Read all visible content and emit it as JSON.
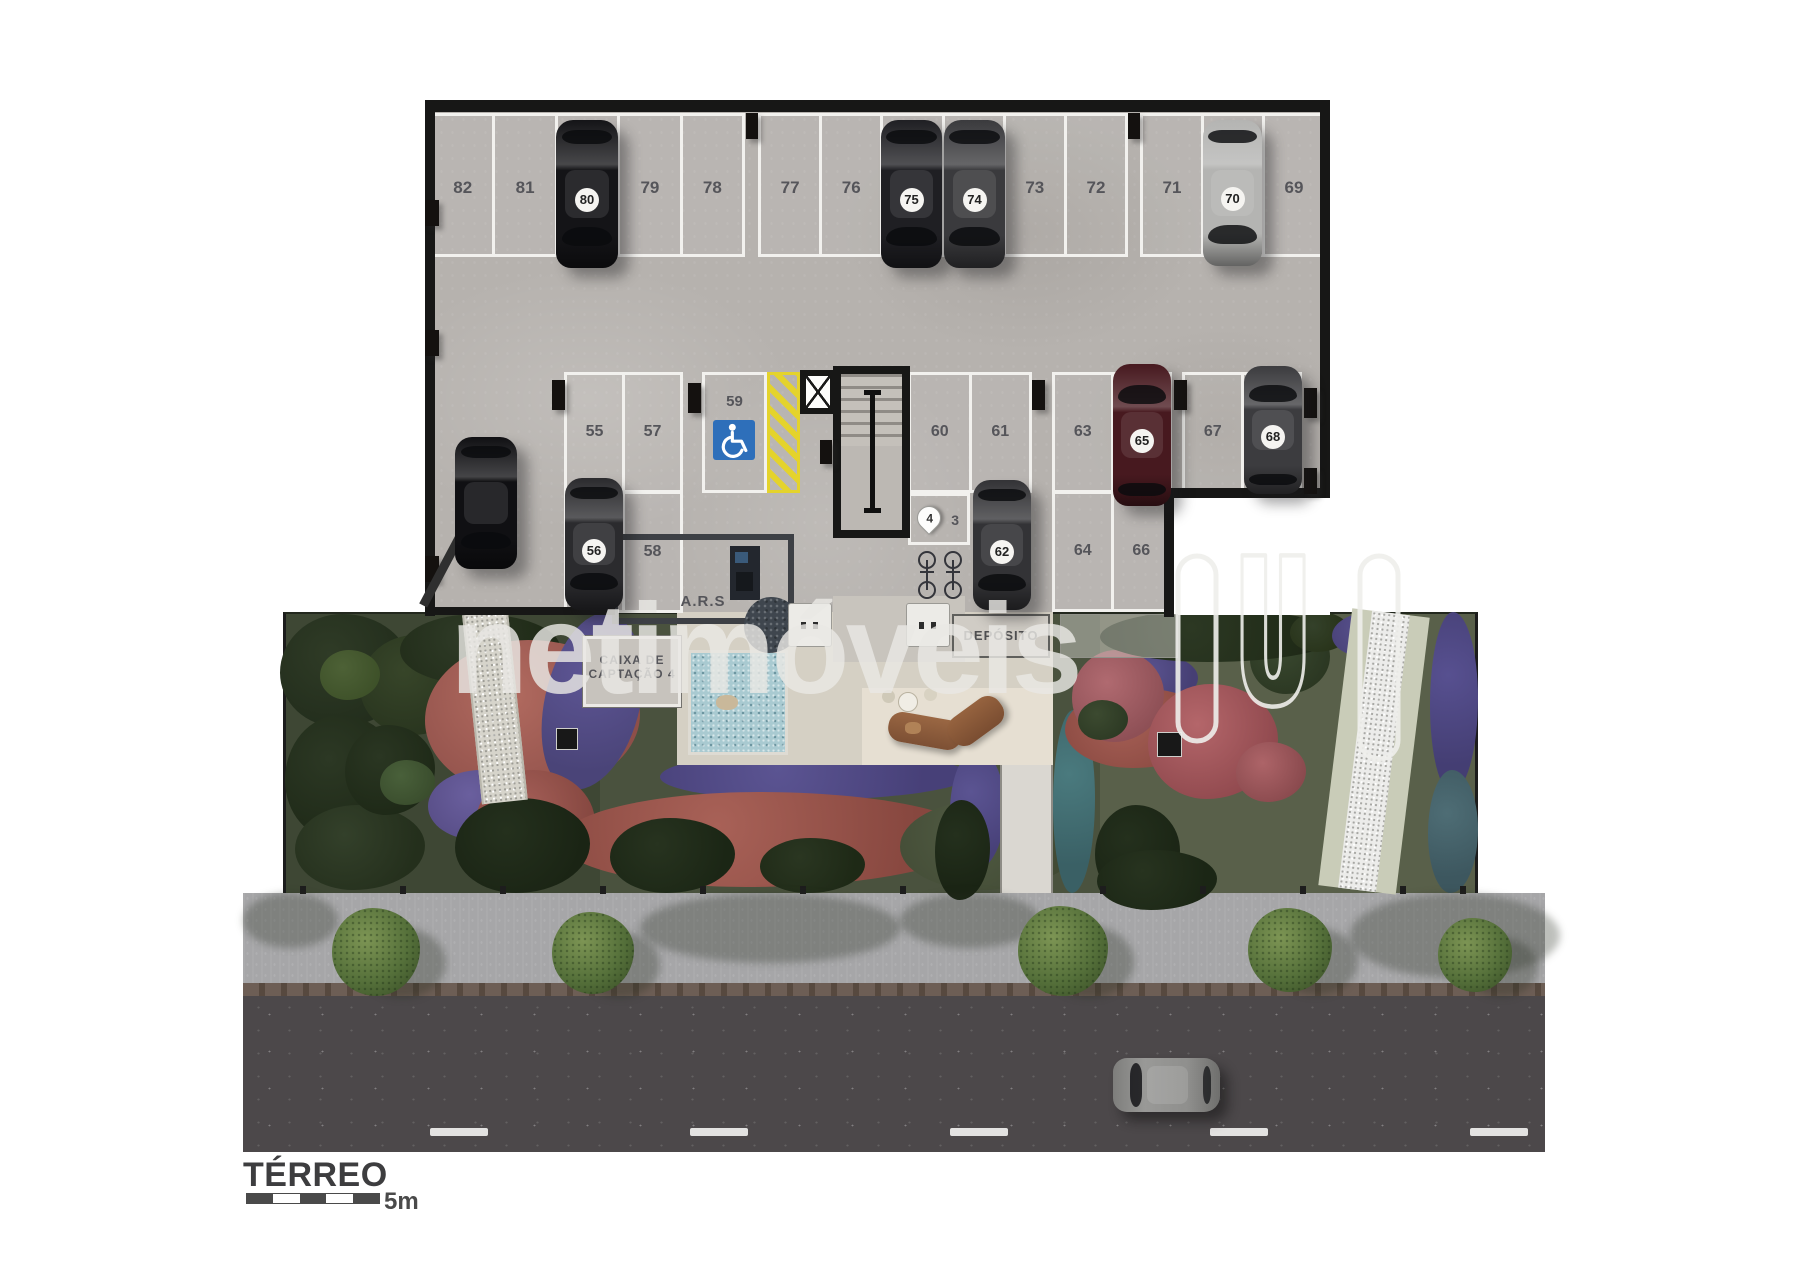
{
  "title_block": {
    "floor_label": "TÉRREO",
    "scale_value": "5m"
  },
  "watermark": {
    "text": "netimóveis",
    "logo_icon": "netimoveis-n-logo",
    "color": "#e9e8e4"
  },
  "garage": {
    "floor_color": "#b6b2ae",
    "wall_color": "#171716",
    "top_row_groups": [
      [
        "82",
        "81",
        "80",
        "79",
        "78"
      ],
      [
        "77",
        "76",
        "75",
        "74",
        "73",
        "72"
      ],
      [
        "71",
        "70",
        "69"
      ]
    ],
    "islands": [
      {
        "id": "a-top",
        "labels": [
          "55",
          "57"
        ]
      },
      {
        "id": "a-bottom",
        "labels": [
          "56",
          "58"
        ]
      },
      {
        "id": "b",
        "labels": [
          "60",
          "61"
        ]
      },
      {
        "id": "c",
        "labels": [
          "63",
          "65"
        ]
      },
      {
        "id": "d",
        "labels": [
          "67",
          "68"
        ]
      },
      {
        "id": "e-bottom",
        "labels": [
          "64",
          "66"
        ]
      }
    ],
    "accessible_stall": {
      "number": "59",
      "icon": "wheelchair-accessible-icon",
      "sign_color": "#2e6fba",
      "hatch_color": "#e4d32c"
    },
    "small_cells": {
      "pin_label": "4",
      "cell_label": "3",
      "pin_icon": "location-pin-icon"
    },
    "rooms": {
      "ars": "A.R.S",
      "caixa_line1": "CAIXA DE",
      "caixa_line2": "CAPTAÇÃO 4",
      "deposito": "DEPÓSITO"
    },
    "icons": [
      "elevator-x-icon",
      "staircase",
      "bicycle-icon"
    ],
    "cars": [
      {
        "badge": "80",
        "color": "#141417"
      },
      {
        "badge": "75",
        "color": "#1f1f23"
      },
      {
        "badge": "74",
        "color": "#3a3a3d"
      },
      {
        "badge": "70",
        "color": "#b4b4b2"
      },
      {
        "badge": "",
        "color": "#101013"
      },
      {
        "badge": "56",
        "color": "#2b2b2e"
      },
      {
        "badge": "62",
        "color": "#333336"
      },
      {
        "badge": "65",
        "color": "#47191f"
      },
      {
        "badge": "68",
        "color": "#3c3c3f"
      }
    ]
  },
  "street": {
    "car_color": "#8f8f8d",
    "lane_marking": "dashed-white-center-line"
  }
}
